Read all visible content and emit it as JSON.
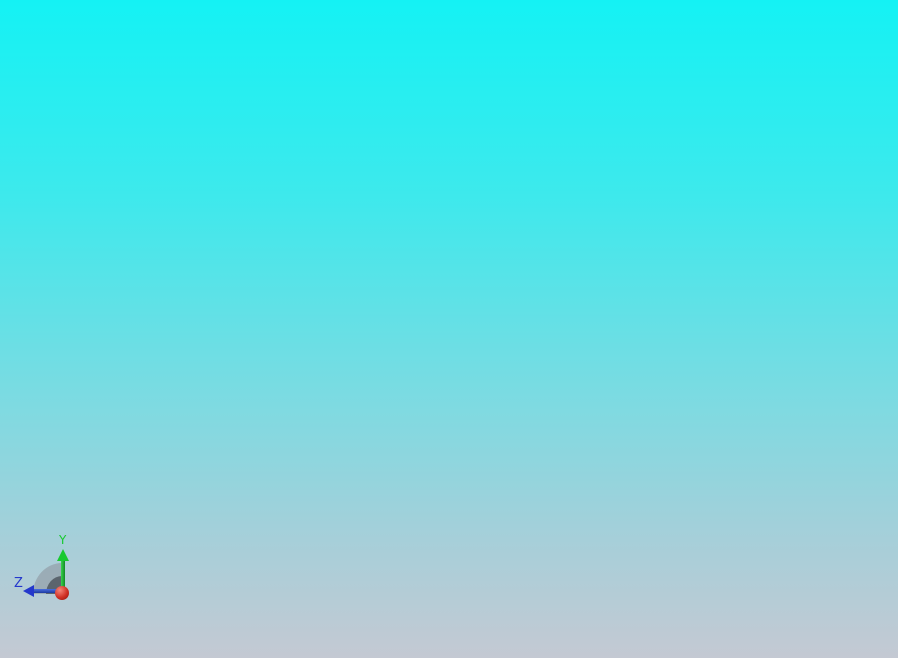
{
  "scene": {
    "view": "cad-front-view",
    "background": {
      "top": "#14F2F4",
      "mid1": "#3EE9EC",
      "mid2": "#7FDAE1",
      "mid3": "#A6CFD9",
      "bottom": "#C4C9D3"
    }
  },
  "triad": {
    "labels": {
      "y": "Y",
      "z": "Z"
    },
    "colors": {
      "y_axis": "#17C92F",
      "z_axis": "#2438CC",
      "origin": "#C42020",
      "disc_outer": "rgba(138,146,154,0.55)",
      "disc_inner": "rgba(80,87,96,0.85)"
    }
  },
  "model": {
    "colors": {
      "panel_gray": "#8A91A2",
      "frame_white": "#F8F9FB",
      "outline": "#14161A",
      "divider_light": "#DFE3F0",
      "base_dark": "#2B2B2D",
      "base_panel": "#343437",
      "handle_accent": "#8FF2F0",
      "handle_dot": "#C6CAD2",
      "cap_segments": [
        "#737B8C",
        "#C6CBD6",
        "#959CAC",
        "#6F7686"
      ]
    },
    "roof": {
      "screw_count": 2
    },
    "left_wall": {
      "tick_groups": 2,
      "ticks_per_group": 10
    },
    "louver_panel": {
      "band_count": 8,
      "divider_count": 7
    },
    "doors": [
      {
        "id": "pair1-left",
        "handle": false
      },
      {
        "id": "pair1-right",
        "handle": true
      },
      {
        "id": "pair2-left",
        "handle": false
      },
      {
        "id": "pair2-right",
        "handle": true
      }
    ],
    "vents": {
      "groups_per_door": 2,
      "columns_per_group": 2,
      "slots_per_column": 10
    },
    "hinges": {
      "edges": 4,
      "per_edge": 2
    },
    "base": {
      "panels": [
        {
          "handle_dots": 3
        },
        {
          "handle_dots": 0
        },
        {
          "handle_dots": 3
        }
      ]
    }
  }
}
